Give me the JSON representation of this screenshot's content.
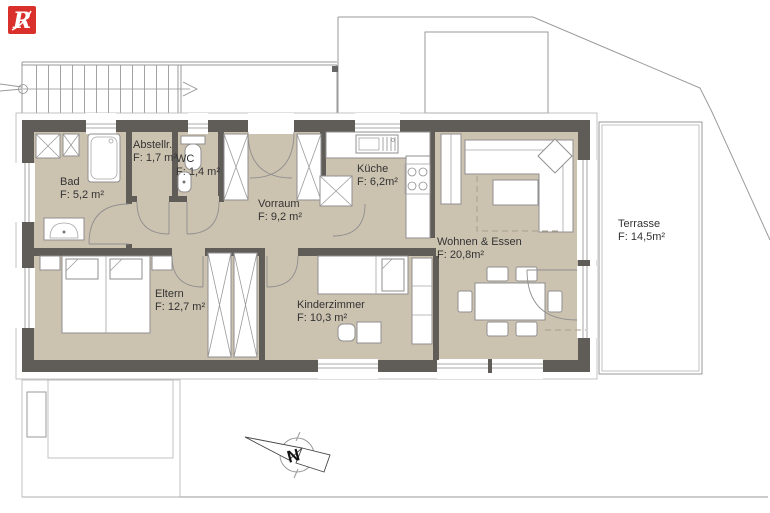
{
  "logo": {
    "letter": "R"
  },
  "rooms": {
    "bad": {
      "name": "Bad",
      "area": "F: 5,2 m²"
    },
    "abstellraum": {
      "name": "Abstellr.",
      "area": "F: 1,7 m²"
    },
    "wc": {
      "name": "WC",
      "area": "F: 1,4 m²"
    },
    "vorraum": {
      "name": "Vorraum",
      "area": "F: 9,2 m²"
    },
    "kueche": {
      "name": "Küche",
      "area": "F: 6,2m²"
    },
    "wohnen_essen": {
      "name": "Wohnen & Essen",
      "area": "F: 20,8m²"
    },
    "eltern": {
      "name": "Eltern",
      "area": "F: 12,7 m²"
    },
    "kinderzimmer": {
      "name": "Kinderzimmer",
      "area": "F: 10,3 m²"
    },
    "terrasse": {
      "name": "Terrasse",
      "area": "F: 14,5m²"
    }
  },
  "compass": {
    "north_letter": "N"
  },
  "colors": {
    "floor": "#ccc2b0",
    "wall": "#605d59",
    "logo_red": "#d9302b",
    "furniture_stroke": "#8f8f8f"
  }
}
